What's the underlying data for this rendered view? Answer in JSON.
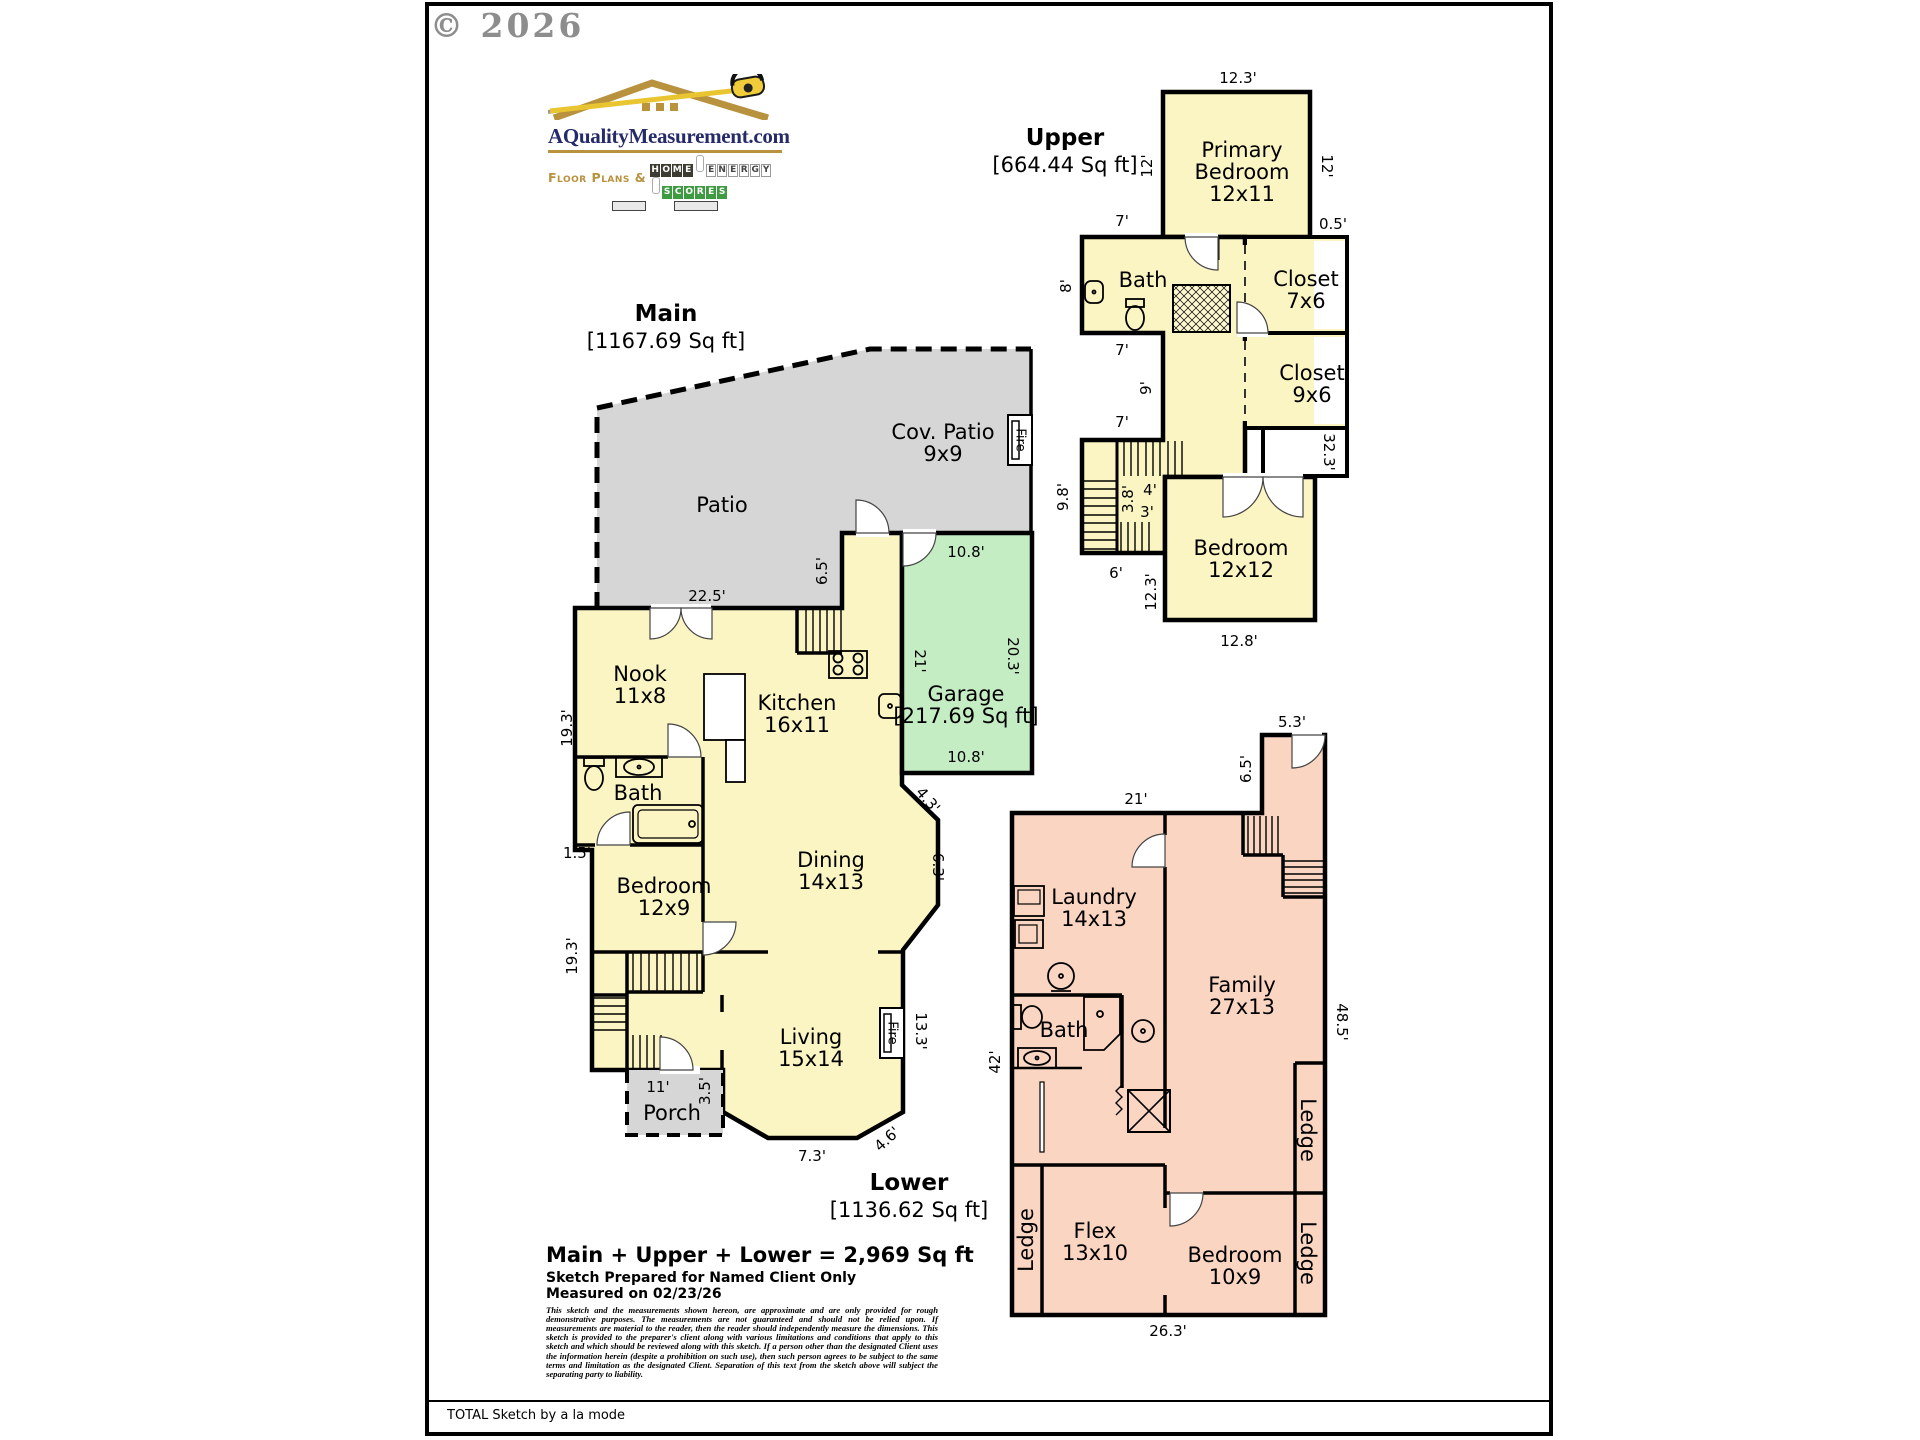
{
  "page": {
    "copyright": "© 2026",
    "footer": "TOTAL Sketch by a la mode"
  },
  "logo": {
    "domain": "AQualityMeasurement.com",
    "tagline_prefix": "Floor Plans &",
    "tiles": [
      {
        "text": "HOME",
        "style": "dark"
      },
      {
        "text": "ENERGY",
        "style": "light"
      },
      {
        "text": "SCORES",
        "style": "green"
      }
    ]
  },
  "summary": {
    "total": "Main + Upper + Lower = 2,969 Sq ft",
    "prepared": "Sketch Prepared for Named Client Only",
    "measured": "Measured on 02/23/26",
    "disclaimer": "This sketch and the measurements shown hereon, are approximate and are only provided for rough demonstrative purposes.  The measurements are not guaranteed and should not be relied upon.  If measurements are material to the reader, then the reader should independently measure the dimensions.  This sketch is provided to the preparer's client along with various limitations and conditions that apply to this sketch and which should be reviewed along with this sketch.  If a person other than the designated Client uses the information herein (despite a prohibition on such use), then such person agrees to be subject to the same terms and limitation as the designated Client.  Separation of this text from the sketch above will subject the separating party to liability."
  },
  "colors": {
    "floor_yellow": "#fbf5c3",
    "floor_salmon": "#f9d5c2",
    "garage_green": "#c5edc4",
    "patio_gray": "#d6d6d6",
    "wall": "#000000",
    "logo_navy": "#252a6a",
    "logo_gold": "#b8923d"
  },
  "levels": {
    "main": {
      "title": "Main",
      "sqft": "[1167.69 Sq ft]",
      "title_x": 666,
      "title_y": 314,
      "rooms": [
        {
          "name": "Cov. Patio",
          "size": "9x9",
          "x": 943,
          "y": 432
        },
        {
          "name": "Patio",
          "x": 722,
          "y": 505
        },
        {
          "name": "Nook",
          "size": "11x8",
          "x": 640,
          "y": 674
        },
        {
          "name": "Kitchen",
          "size": "16x11",
          "x": 797,
          "y": 703
        },
        {
          "name": "Garage",
          "size": "[217.69 Sq ft]",
          "x": 966,
          "y": 694
        },
        {
          "name": "Bath",
          "x": 638,
          "y": 793
        },
        {
          "name": "Dining",
          "size": "14x13",
          "x": 831,
          "y": 860
        },
        {
          "name": "Bedroom",
          "size": "12x9",
          "x": 664,
          "y": 886
        },
        {
          "name": "Living",
          "size": "15x14",
          "x": 811,
          "y": 1037
        },
        {
          "name": "Porch",
          "x": 672,
          "y": 1113
        },
        {
          "name": "Fire",
          "x": 1020,
          "y": 440,
          "rot": 90,
          "cls": "fire"
        },
        {
          "name": "Fire",
          "x": 892,
          "y": 1033,
          "rot": 90,
          "cls": "fire"
        }
      ],
      "dims": [
        {
          "t": "22.5'",
          "x": 707,
          "y": 596
        },
        {
          "t": "6.5'",
          "x": 822,
          "y": 571,
          "r": -90
        },
        {
          "t": "10.8'",
          "x": 966,
          "y": 552
        },
        {
          "t": "21'",
          "x": 920,
          "y": 661,
          "r": 90
        },
        {
          "t": "20.3'",
          "x": 1013,
          "y": 656,
          "r": 90
        },
        {
          "t": "10.8'",
          "x": 966,
          "y": 757
        },
        {
          "t": "19.3'",
          "x": 567,
          "y": 728,
          "r": -90
        },
        {
          "t": "1.5'",
          "x": 577,
          "y": 853
        },
        {
          "t": "19.3'",
          "x": 572,
          "y": 956,
          "r": -90
        },
        {
          "t": "4.3'",
          "x": 928,
          "y": 800,
          "r": 50
        },
        {
          "t": "6.3'",
          "x": 938,
          "y": 867,
          "r": 90
        },
        {
          "t": "13.3'",
          "x": 921,
          "y": 1031,
          "r": 90
        },
        {
          "t": "11'",
          "x": 658,
          "y": 1087
        },
        {
          "t": "3.5'",
          "x": 705,
          "y": 1091,
          "r": -90
        },
        {
          "t": "7.3'",
          "x": 812,
          "y": 1156
        },
        {
          "t": "4.6'",
          "x": 887,
          "y": 1139,
          "r": -42
        }
      ]
    },
    "upper": {
      "title": "Upper",
      "sqft": "[664.44 Sq ft]",
      "title_x": 1065,
      "title_y": 138,
      "rooms": [
        {
          "name": "Primary\nBedroom",
          "size": "12x11",
          "x": 1242,
          "y": 150
        },
        {
          "name": "Bath",
          "x": 1143,
          "y": 280
        },
        {
          "name": "Closet",
          "size": "7x6",
          "x": 1306,
          "y": 279
        },
        {
          "name": "Closet",
          "size": "9x6",
          "x": 1312,
          "y": 373
        },
        {
          "name": "Bedroom",
          "size": "12x12",
          "x": 1241,
          "y": 548
        }
      ],
      "dims": [
        {
          "t": "12.3'",
          "x": 1238,
          "y": 78
        },
        {
          "t": "12'",
          "x": 1147,
          "y": 166,
          "r": -90
        },
        {
          "t": "12'",
          "x": 1327,
          "y": 166,
          "r": 90
        },
        {
          "t": "7'",
          "x": 1122,
          "y": 221
        },
        {
          "t": "0.5'",
          "x": 1333,
          "y": 224
        },
        {
          "t": "8'",
          "x": 1066,
          "y": 286,
          "r": -90
        },
        {
          "t": "7'",
          "x": 1122,
          "y": 350
        },
        {
          "t": "9'",
          "x": 1146,
          "y": 388,
          "r": -90
        },
        {
          "t": "7'",
          "x": 1122,
          "y": 422
        },
        {
          "t": "32.3'",
          "x": 1329,
          "y": 452,
          "r": 90
        },
        {
          "t": "4'",
          "x": 1150,
          "y": 490
        },
        {
          "t": "9.8'",
          "x": 1063,
          "y": 497,
          "r": -90
        },
        {
          "t": "3.8'",
          "x": 1128,
          "y": 499,
          "r": -90
        },
        {
          "t": "3'",
          "x": 1147,
          "y": 512
        },
        {
          "t": "6'",
          "x": 1116,
          "y": 573
        },
        {
          "t": "12.3'",
          "x": 1151,
          "y": 592,
          "r": -90
        },
        {
          "t": "12.8'",
          "x": 1239,
          "y": 641
        }
      ]
    },
    "lower": {
      "title": "Lower",
      "sqft": "[1136.62 Sq ft]",
      "title_x": 909,
      "title_y": 1183,
      "rooms": [
        {
          "name": "Laundry",
          "size": "14x13",
          "x": 1094,
          "y": 897
        },
        {
          "name": "Family",
          "size": "27x13",
          "x": 1242,
          "y": 985
        },
        {
          "name": "Bath",
          "x": 1064,
          "y": 1030
        },
        {
          "name": "Flex",
          "size": "13x10",
          "x": 1095,
          "y": 1231
        },
        {
          "name": "Bedroom",
          "size": "10x9",
          "x": 1235,
          "y": 1255
        },
        {
          "name": "Ledge",
          "x": 1026,
          "y": 1240,
          "rot": -90
        },
        {
          "name": "Ledge",
          "x": 1308,
          "y": 1130,
          "rot": 90
        },
        {
          "name": "Ledge",
          "x": 1308,
          "y": 1253,
          "rot": 90
        }
      ],
      "dims": [
        {
          "t": "5.3'",
          "x": 1292,
          "y": 722
        },
        {
          "t": "6.5'",
          "x": 1246,
          "y": 769,
          "r": -90
        },
        {
          "t": "21'",
          "x": 1136,
          "y": 799
        },
        {
          "t": "48.5'",
          "x": 1342,
          "y": 1022,
          "r": 90
        },
        {
          "t": "42'",
          "x": 995,
          "y": 1062,
          "r": -90
        },
        {
          "t": "26.3'",
          "x": 1168,
          "y": 1331
        }
      ]
    }
  }
}
